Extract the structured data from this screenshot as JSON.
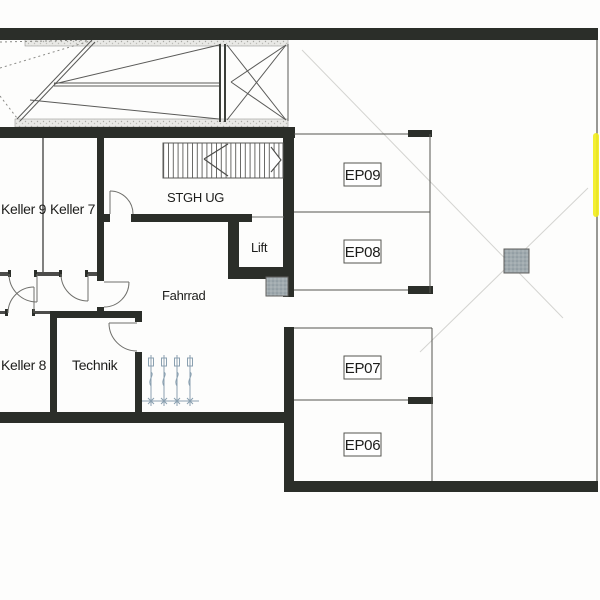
{
  "floorplan": {
    "rooms": [
      {
        "label": "Keller 9"
      },
      {
        "label": "Keller 7"
      },
      {
        "label": "STGH UG"
      },
      {
        "label": "Lift"
      },
      {
        "label": "Fahrrad"
      },
      {
        "label": "Keller 8"
      },
      {
        "label": "Technik"
      }
    ],
    "parking_spaces": [
      {
        "label": "EP09"
      },
      {
        "label": "EP08"
      },
      {
        "label": "EP07"
      },
      {
        "label": "EP06"
      }
    ],
    "colors": {
      "wall": "#2b2e29",
      "thin_wall": "#4c4c4a",
      "paper": "#fdfdfc",
      "hatch_fill": "#e9e9e6",
      "column_fill": "#a0aaae",
      "marker_highlight": "#f2ee20",
      "plumbing_symbol": "#8aa0b0",
      "faint_guide": "#d4d4d1"
    },
    "symbols": [
      "ramp-hatching-icon",
      "stair-run-icon",
      "door-swing-icon",
      "lift-shaft-icon",
      "structural-column-icon",
      "plumbing-riser-icon",
      "highlighter-mark-icon"
    ]
  }
}
